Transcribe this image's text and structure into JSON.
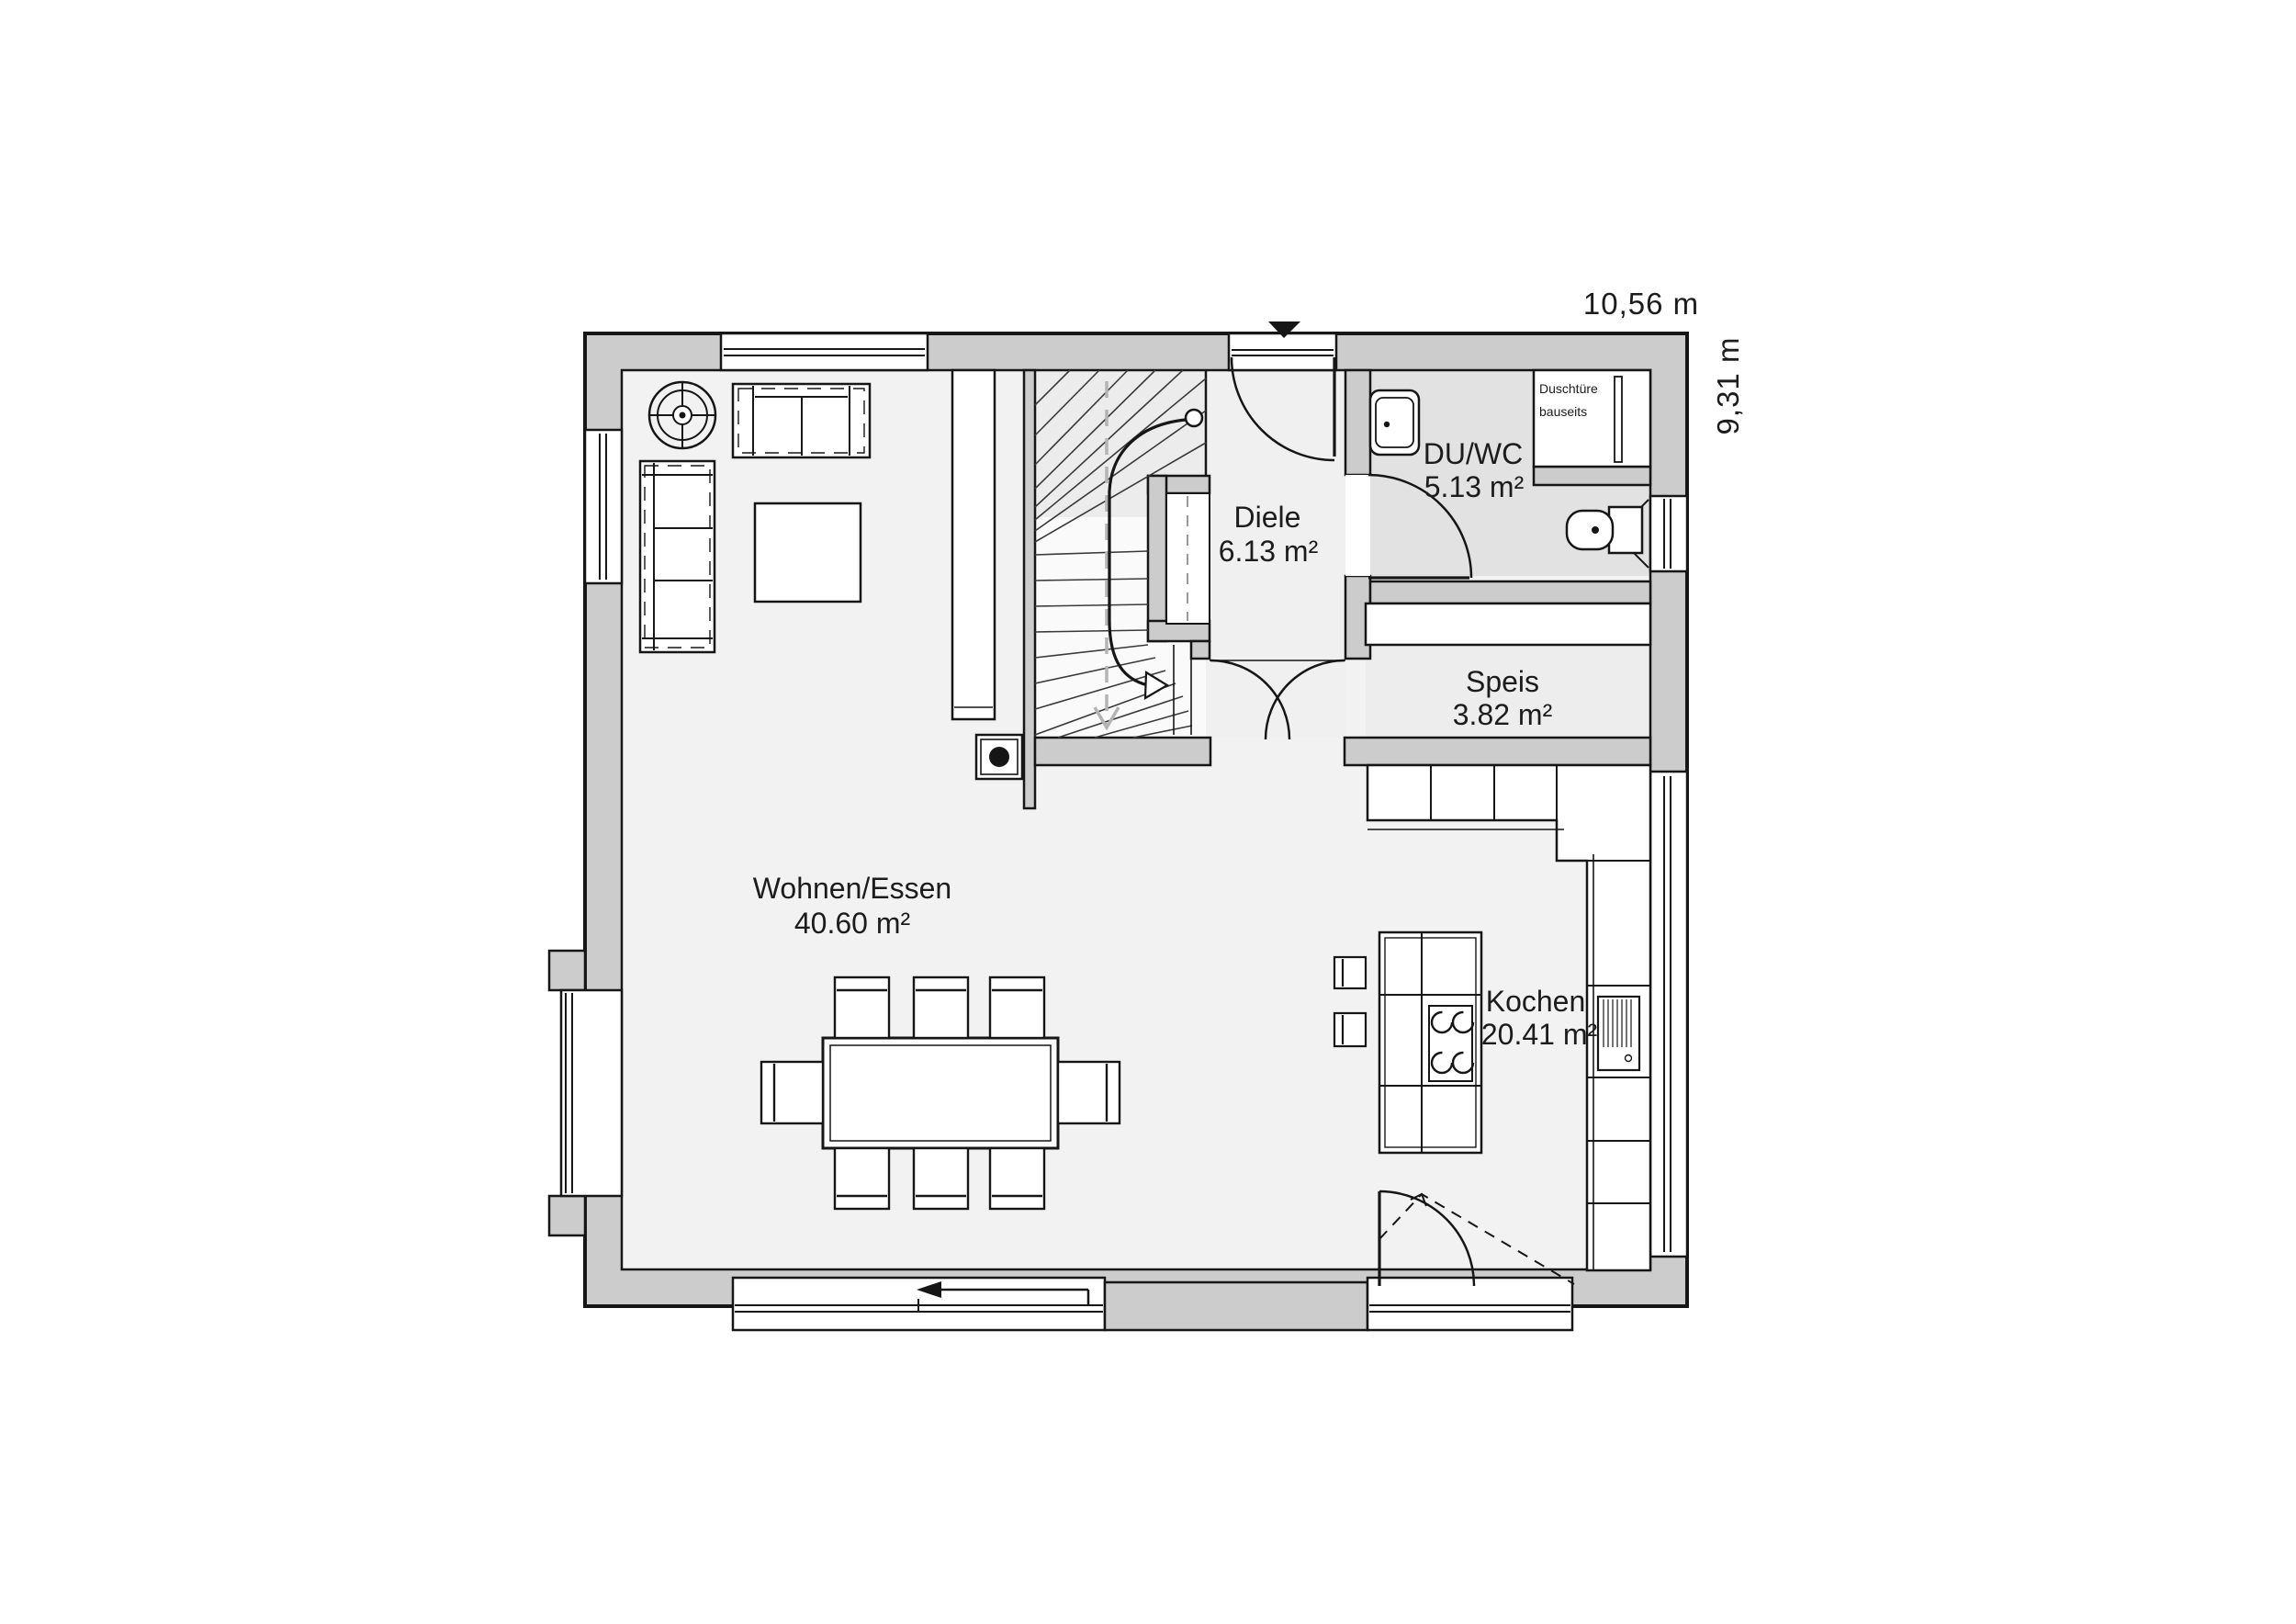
{
  "plan": {
    "dimensions": {
      "width_label": "10,56 m",
      "depth_label": "9,31 m"
    },
    "rooms": [
      {
        "name": "Wohnen/Essen",
        "area": "40.60 m²"
      },
      {
        "name": "Diele",
        "area": "6.13 m²"
      },
      {
        "name": "DU/WC",
        "area": "5.13 m²"
      },
      {
        "name": "Speis",
        "area": "3.82 m²"
      },
      {
        "name": "Kochen",
        "area": "20.41 m²"
      }
    ],
    "annotations": {
      "shower_note_line1": "Duschtüre",
      "shower_note_line2": "bauseits"
    },
    "colors": {
      "wall": "#cccccc",
      "line": "#161616",
      "floor": "#f2f2f2",
      "floor_wet": "#e2e2e2"
    }
  }
}
